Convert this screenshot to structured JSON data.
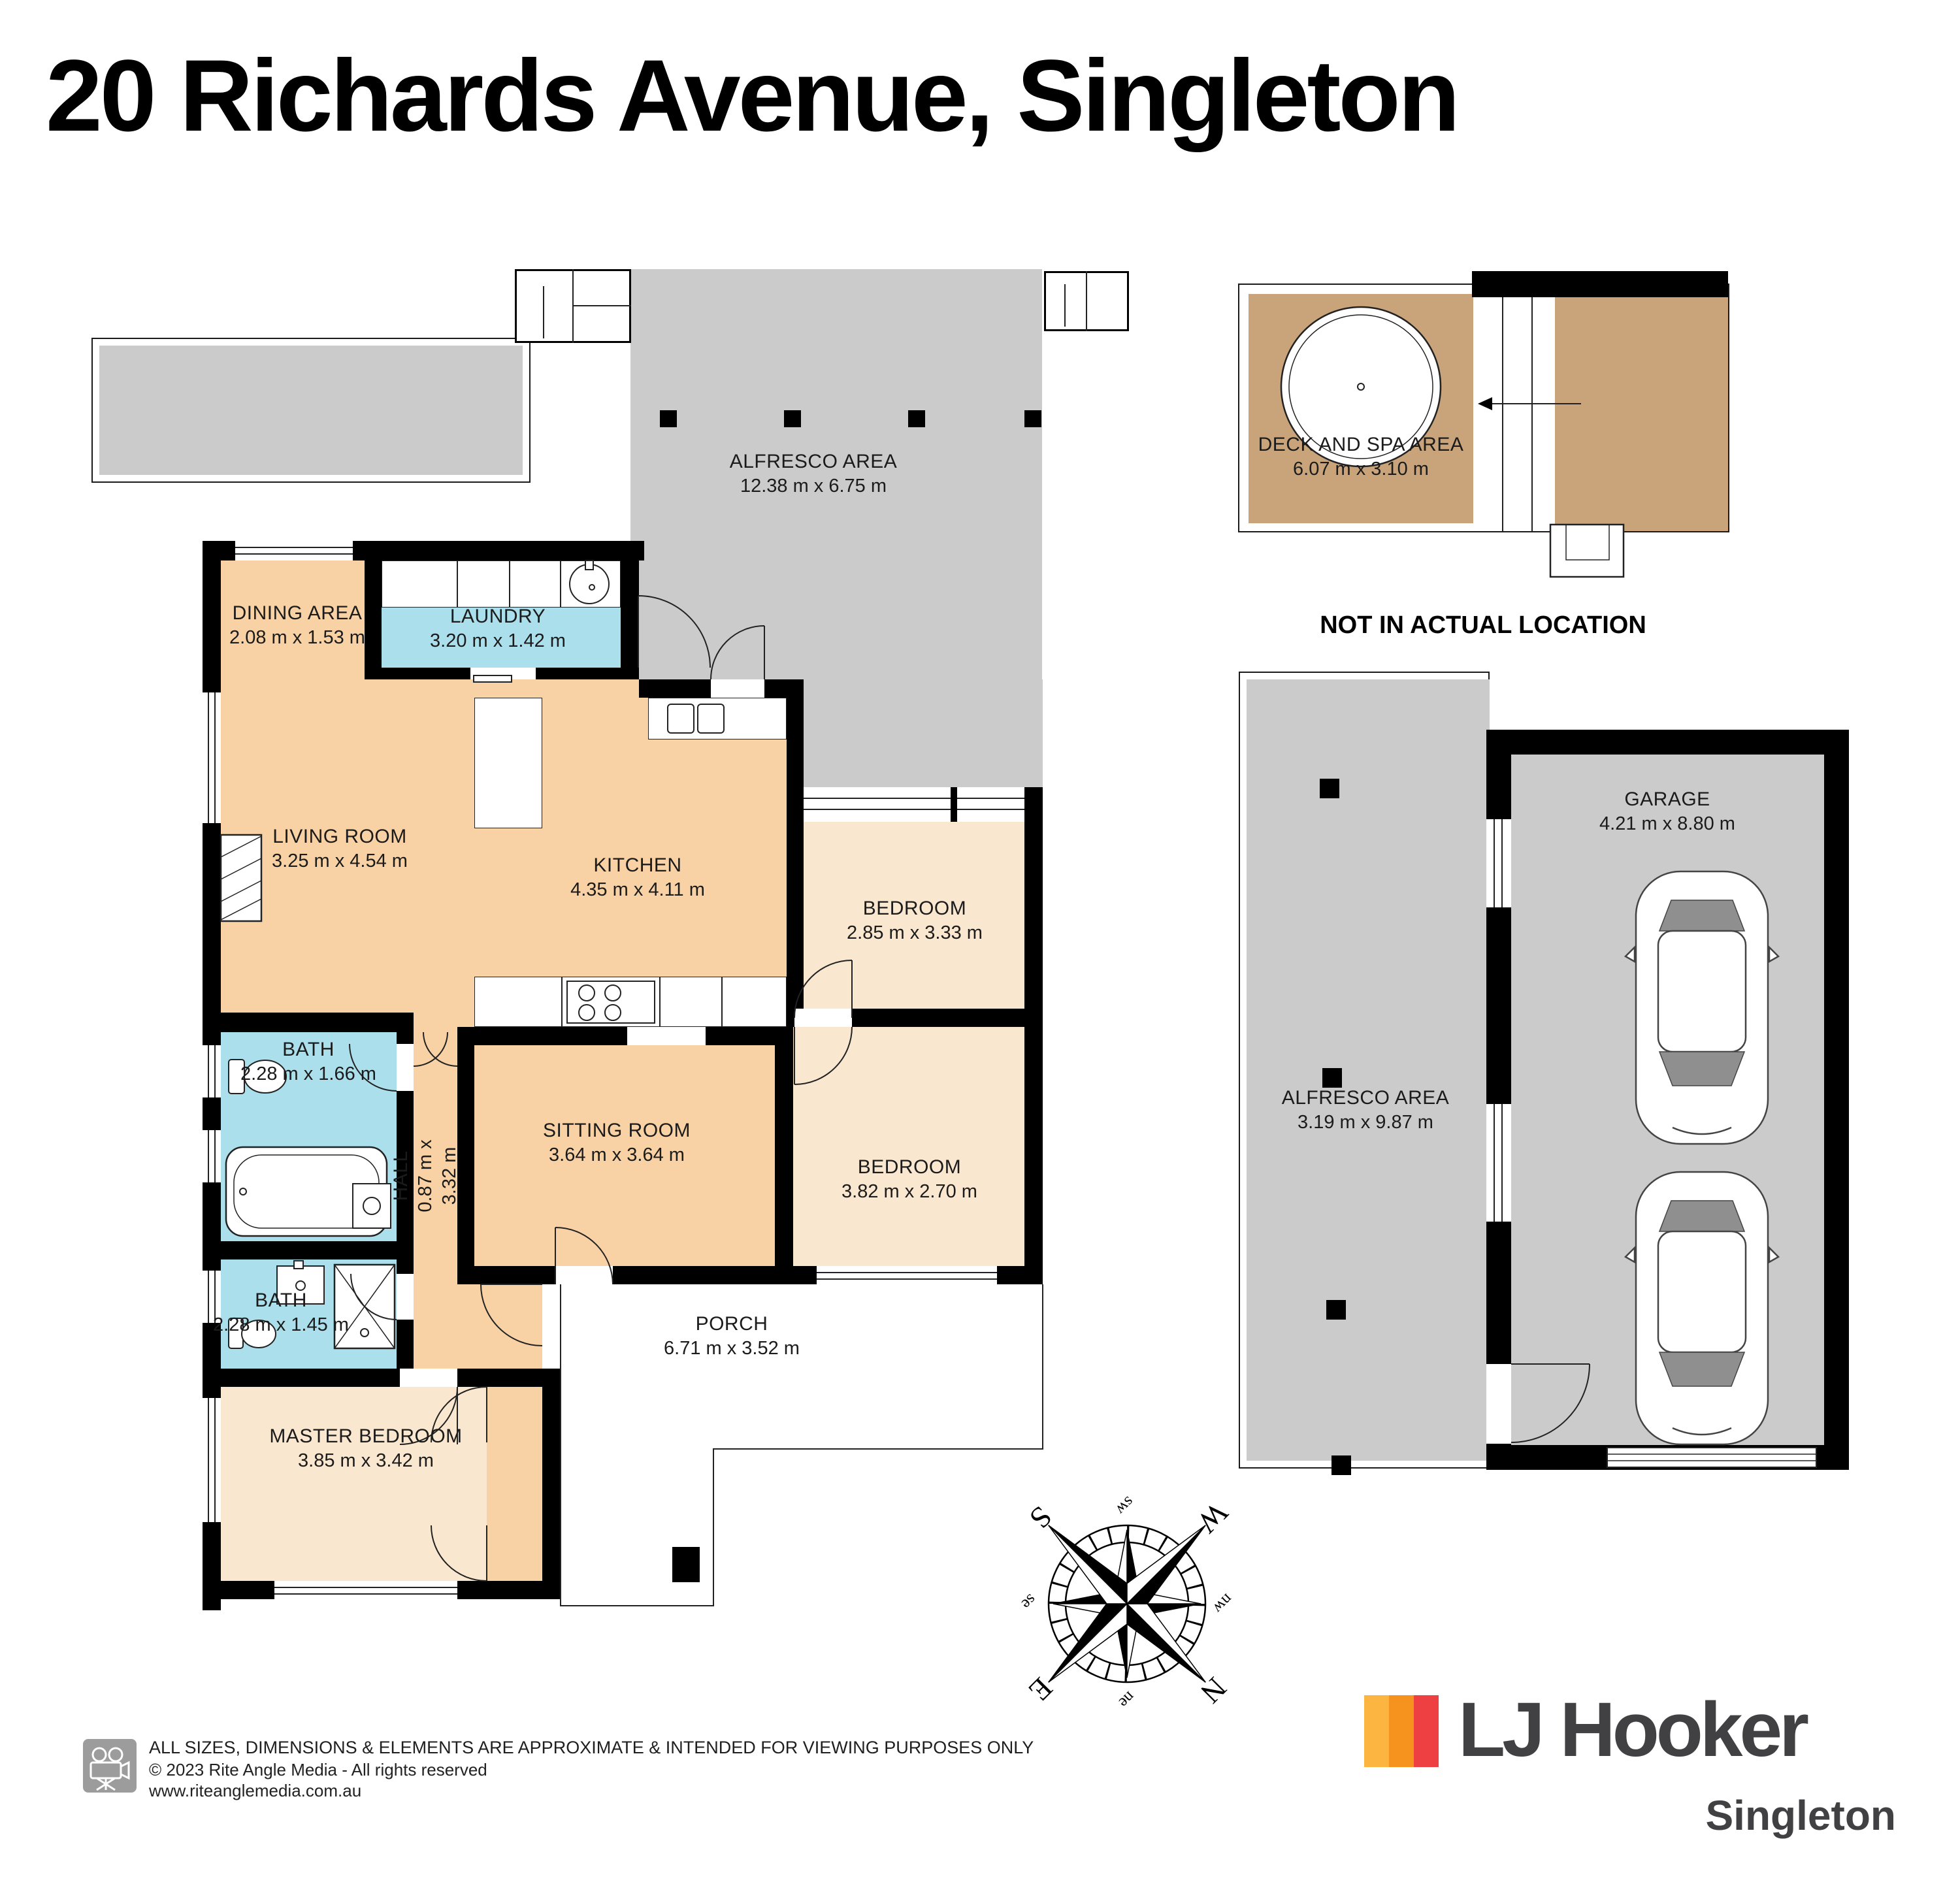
{
  "title": "20 Richards Avenue, Singleton",
  "floorplan": {
    "alfresco": {
      "name": "ALFRESCO AREA",
      "dims": "12.38 m x 6.75 m"
    },
    "dining": {
      "name": "DINING AREA",
      "dims": "2.08 m x 1.53 m"
    },
    "laundry": {
      "name": "LAUNDRY",
      "dims": "3.20 m x 1.42 m"
    },
    "living": {
      "name": "LIVING ROOM",
      "dims": "3.25 m x 4.54 m"
    },
    "kitchen": {
      "name": "KITCHEN",
      "dims": "4.35 m x 4.11 m"
    },
    "bedroom1": {
      "name": "BEDROOM",
      "dims": "2.85 m x 3.33 m"
    },
    "bath1": {
      "name": "BATH",
      "dims": "2.28 m x 1.66 m"
    },
    "hall": {
      "name": "HALL",
      "dims": "0.87 m x 3.32 m"
    },
    "sitting": {
      "name": "SITTING ROOM",
      "dims": "3.64 m x 3.64 m"
    },
    "bedroom2": {
      "name": "BEDROOM",
      "dims": "3.82 m x 2.70 m"
    },
    "bath2": {
      "name": "BATH",
      "dims": "2.28 m x 1.45 m"
    },
    "master": {
      "name": "MASTER BEDROOM",
      "dims": "3.85 m x 3.42 m"
    },
    "porch": {
      "name": "PORCH",
      "dims": "6.71 m x 3.52 m"
    }
  },
  "deck": {
    "name": "DECK AND SPA AREA",
    "dims": "6.07 m x 3.10 m",
    "note": "NOT IN ACTUAL LOCATION"
  },
  "right_plan": {
    "alfresco": {
      "name": "ALFRESCO AREA",
      "dims": "3.19 m x 9.87 m"
    },
    "garage": {
      "name": "GARAGE",
      "dims": "4.21 m x 8.80 m"
    }
  },
  "compass": {
    "n": "N",
    "e": "E",
    "s": "S",
    "w": "W",
    "ne": "ne",
    "se": "se",
    "sw": "sw",
    "nw": "nw"
  },
  "footer": {
    "disclaimer": "ALL SIZES, DIMENSIONS & ELEMENTS ARE APPROXIMATE & INTENDED FOR VIEWING PURPOSES ONLY",
    "copyright": "© 2023 Rite Angle Media - All rights reserved",
    "website": "www.riteanglemedia.com.au"
  },
  "brand": {
    "name": "LJ Hooker",
    "location": "Singleton"
  },
  "colors": {
    "room_peach": "#F8D2A4",
    "room_light": "#FAE7CF",
    "wet_blue": "#ABDFEB",
    "alfresco_gray": "#CBCBCB",
    "deck_brown": "#C9A47B",
    "wall": "#000000",
    "brand_yellow": "#FBB540",
    "brand_orange": "#F6931E",
    "brand_red": "#EE4043",
    "brand_text": "#414042"
  }
}
